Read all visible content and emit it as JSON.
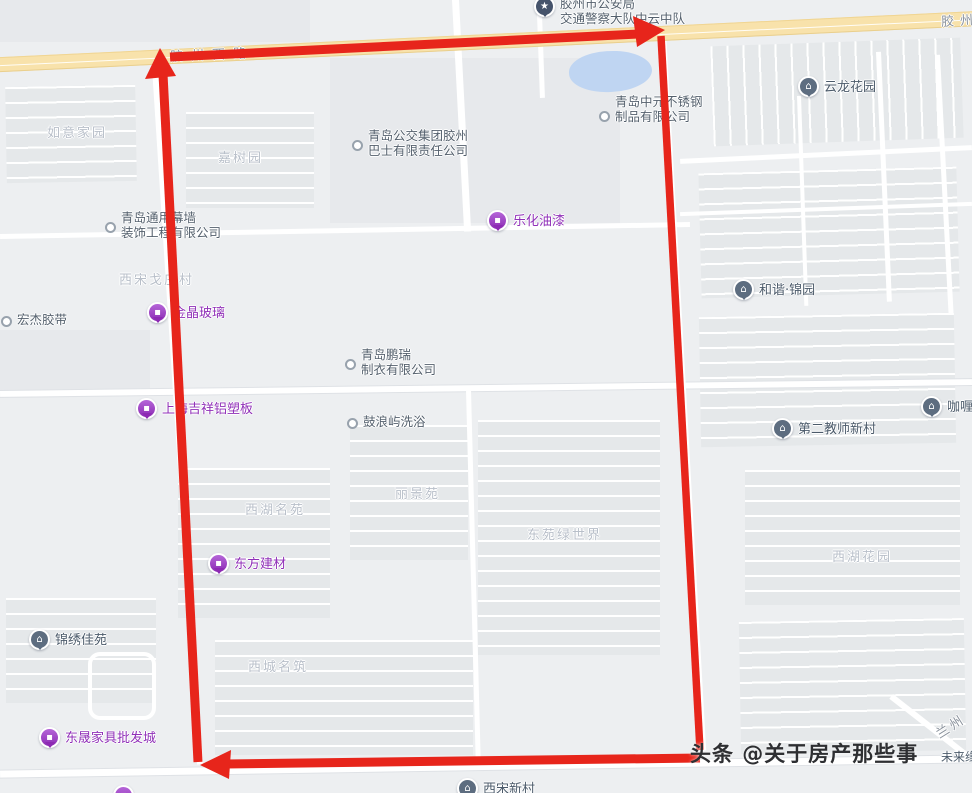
{
  "colors": {
    "annotation_red": "#e7251b",
    "road_yellow": "#f8e2ab",
    "pond_blue": "#bfd5f2",
    "poi_purple_text": "#9030b8",
    "poi_gray_text": "#4b5a6a",
    "area_label_text": "#b8bfc9"
  },
  "annotation": {
    "shape": "rectangular route traced with red arrows (up, right, left)",
    "color": "#e7251b"
  },
  "road_labels": [
    {
      "text": "胶州西路"
    },
    {
      "text": "胶州"
    },
    {
      "text": "兰州"
    }
  ],
  "areas": [
    {
      "text": "如意家园"
    },
    {
      "text": "嘉树园"
    },
    {
      "text": "西宋戈庄村"
    },
    {
      "text": "西湖名苑"
    },
    {
      "text": "丽景苑"
    },
    {
      "text": "东苑绿世界"
    },
    {
      "text": "西湖花园"
    },
    {
      "text": "西城名筑"
    }
  ],
  "poi_gray": [
    {
      "text": "云龙花园"
    },
    {
      "text": "和谐·锦园"
    },
    {
      "text": "第二教师新村"
    },
    {
      "text": "咖喱"
    },
    {
      "text": "锦绣佳苑"
    },
    {
      "text": "西宋新村"
    },
    {
      "text": "未来缘"
    }
  ],
  "poi_purple": [
    {
      "text": "乐化油漆"
    },
    {
      "text": "金晶玻璃"
    },
    {
      "text": "上海吉祥铝塑板"
    },
    {
      "text": "东方建材"
    },
    {
      "text": "东晟家具批发城"
    }
  ],
  "companies": [
    {
      "line1": "青岛中元不锈钢",
      "line2": "制品有限公司"
    },
    {
      "line1": "青岛公交集团胶州",
      "line2": "巴士有限责任公司"
    },
    {
      "line1": "青岛通用幕墙",
      "line2": "装饰工程有限公司"
    },
    {
      "line1": "青岛鹏瑞",
      "line2": "制衣有限公司"
    },
    {
      "line1": "鼓浪屿洗浴",
      "line2": ""
    },
    {
      "line1": "宏杰胶带",
      "line2": ""
    }
  ],
  "police": {
    "line1": "胶州市公安局",
    "line2": "交通警察大队中云中队"
  },
  "watermark": {
    "text": "头条 @关于房产那些事"
  },
  "icons": {
    "house_pin": "⌂",
    "purple_pin": "▪",
    "police_pin": "★"
  }
}
